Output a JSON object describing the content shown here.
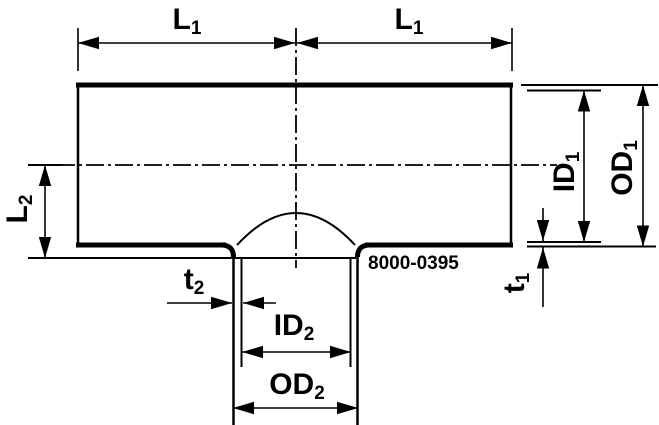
{
  "drawing": {
    "description": "Dimensioned cross-section drawing of a pipe tee fitting with bottom branch outlet",
    "background_color": "#ffffff",
    "line_color": "#000000",
    "part_number": "8000-0395",
    "labels": {
      "l1_left": {
        "base": "L",
        "sub": "1"
      },
      "l1_right": {
        "base": "L",
        "sub": "1"
      },
      "l2": {
        "base": "L",
        "sub": "2"
      },
      "t1": {
        "base": "t",
        "sub": "1"
      },
      "t2": {
        "base": "t",
        "sub": "2"
      },
      "id1": {
        "base": "ID",
        "sub": "1"
      },
      "od1": {
        "base": "OD",
        "sub": "1"
      },
      "id2": {
        "base": "ID",
        "sub": "2"
      },
      "od2": {
        "base": "OD",
        "sub": "2"
      }
    }
  }
}
